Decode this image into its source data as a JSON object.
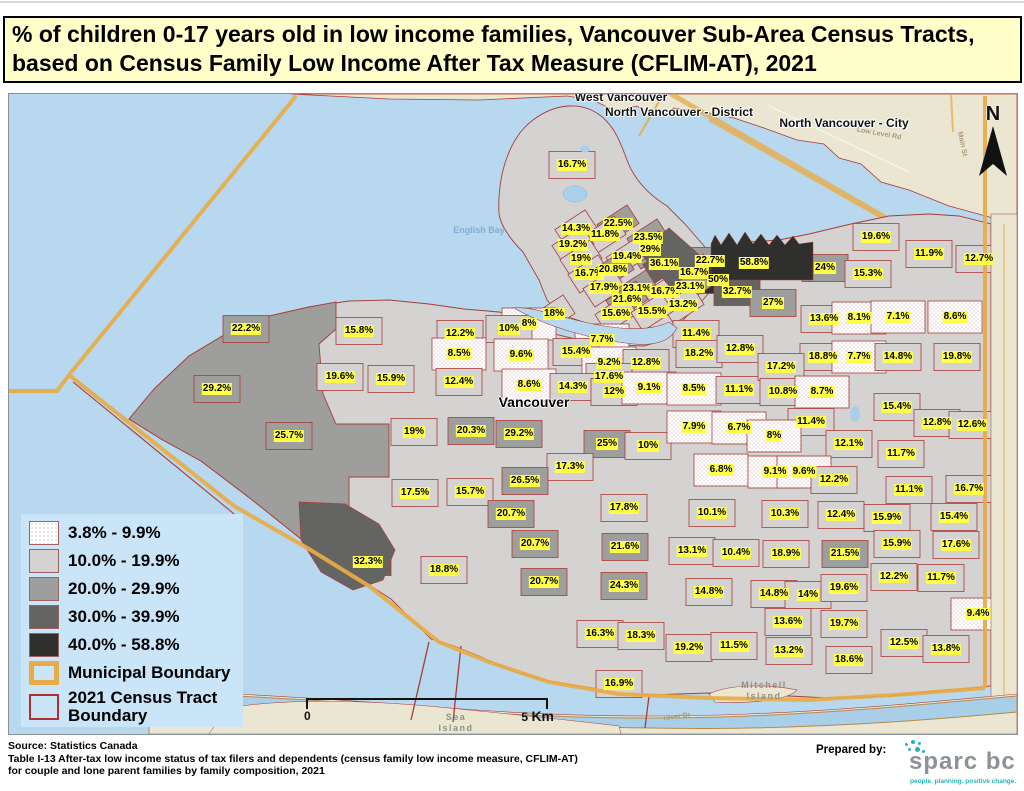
{
  "title": "% of children 0-17 years old in low income families, Vancouver Sub-Area Census Tracts, based on Census Family Low Income After Tax Measure (CFLIM-AT), 2021",
  "legend": {
    "classes": [
      {
        "label": "3.8% - 9.9%",
        "fill": "stipple"
      },
      {
        "label": "10.0% - 19.9%",
        "fill": "#d4d3d1"
      },
      {
        "label": "20.0% - 29.9%",
        "fill": "#9e9e9c"
      },
      {
        "label": "30.0% - 39.9%",
        "fill": "#646462"
      },
      {
        "label": "40.0% - 58.8%",
        "fill": "#2f2f2d"
      }
    ],
    "municipal_label": "Municipal Boundary",
    "census_line1": "2021 Census Tract",
    "census_line2": "Boundary"
  },
  "scale": {
    "zero": "0",
    "five": "5",
    "unit": "Km"
  },
  "north": {
    "letter": "N"
  },
  "colors": {
    "water": "#b7d8ee",
    "land_outside": "#ebe6d2",
    "legend_bg": "#c9e5f7",
    "label_bg": "#ffff4a",
    "municipal_boundary": "#e8ab47",
    "tract_boundary": "#a83c38",
    "title_bg": "#ffffc9",
    "logo_teal": "#26b3b3"
  },
  "map": {
    "places": [
      {
        "t": "West Vancouver",
        "x": 620,
        "y": 96,
        "c": "city",
        "rot": 0
      },
      {
        "t": "North Vancouver - District",
        "x": 678,
        "y": 111,
        "c": "city",
        "rot": 0
      },
      {
        "t": "North Vancouver - City",
        "x": 843,
        "y": 122,
        "c": "city",
        "rot": 0
      },
      {
        "t": "Vancouver",
        "x": 533,
        "y": 401,
        "c": "city-major",
        "rot": 0
      },
      {
        "t": "English Bay",
        "x": 478,
        "y": 229,
        "c": "water",
        "rot": 0
      },
      {
        "t": "Sea Island",
        "x": 455,
        "y": 722,
        "c": "island",
        "rot": 0
      },
      {
        "t": "Mitchell Island",
        "x": 763,
        "y": 690,
        "c": "island",
        "rot": 0
      },
      {
        "t": "River Dr",
        "x": 676,
        "y": 716,
        "c": "road",
        "rot": -8
      },
      {
        "t": "Low Level Rd",
        "x": 878,
        "y": 133,
        "c": "road",
        "rot": 10
      },
      {
        "t": "Main St",
        "x": 961,
        "y": 143,
        "c": "road",
        "rot": 78
      }
    ],
    "tracts_vxy": [
      [
        "16.7%",
        571,
        164
      ],
      [
        "14.3%",
        575,
        228
      ],
      [
        "22.5%",
        617,
        223
      ],
      [
        "11.8%",
        604,
        234
      ],
      [
        "23.5%",
        647,
        237
      ],
      [
        "19.2%",
        572,
        244
      ],
      [
        "29%",
        649,
        249
      ],
      [
        "19%",
        580,
        258
      ],
      [
        "19.4%",
        626,
        256
      ],
      [
        "36.1%",
        663,
        263
      ],
      [
        "22.7%",
        709,
        260
      ],
      [
        "58.8%",
        753,
        262
      ],
      [
        "16.7%",
        588,
        273
      ],
      [
        "20.8%",
        612,
        269
      ],
      [
        "16.7%",
        693,
        272
      ],
      [
        "50%",
        717,
        279
      ],
      [
        "17.9%",
        603,
        287
      ],
      [
        "23.1%",
        636,
        288
      ],
      [
        "16.7%",
        664,
        291
      ],
      [
        "23.1%",
        689,
        286
      ],
      [
        "32.7%",
        736,
        291
      ],
      [
        "21.6%",
        626,
        299
      ],
      [
        "13.2%",
        682,
        304
      ],
      [
        "27%",
        772,
        302
      ],
      [
        "15.6%",
        615,
        313
      ],
      [
        "15.5%",
        651,
        311
      ],
      [
        "22.2%",
        245,
        328
      ],
      [
        "15.8%",
        358,
        330
      ],
      [
        "12.2%",
        459,
        333
      ],
      [
        "8.5%",
        458,
        353
      ],
      [
        "19.6%",
        339,
        376
      ],
      [
        "15.9%",
        390,
        378
      ],
      [
        "12.4%",
        458,
        381
      ],
      [
        "29.2%",
        216,
        388
      ],
      [
        "25.7%",
        288,
        435
      ],
      [
        "18%",
        553,
        313
      ],
      [
        "8%",
        528,
        323
      ],
      [
        "10%",
        508,
        328
      ],
      [
        "7.7%",
        601,
        339
      ],
      [
        "11.4%",
        695,
        333
      ],
      [
        "9.6%",
        520,
        354
      ],
      [
        "15.4%",
        575,
        351
      ],
      [
        "9.2%",
        608,
        362
      ],
      [
        "12.8%",
        645,
        362
      ],
      [
        "18.2%",
        698,
        353
      ],
      [
        "12.8%",
        739,
        348
      ],
      [
        "17.6%",
        608,
        376
      ],
      [
        "8.6%",
        528,
        384
      ],
      [
        "14.3%",
        572,
        386
      ],
      [
        "12%",
        613,
        391
      ],
      [
        "9.1%",
        648,
        387
      ],
      [
        "8.5%",
        693,
        388
      ],
      [
        "11.1%",
        738,
        389
      ],
      [
        "19%",
        413,
        431
      ],
      [
        "20.3%",
        470,
        430
      ],
      [
        "29.2%",
        518,
        433
      ],
      [
        "25%",
        606,
        443
      ],
      [
        "10%",
        647,
        445
      ],
      [
        "7.9%",
        693,
        426
      ],
      [
        "6.7%",
        738,
        427
      ],
      [
        "17.3%",
        569,
        466
      ],
      [
        "26.5%",
        524,
        480
      ],
      [
        "6.8%",
        720,
        469
      ],
      [
        "17.5%",
        414,
        492
      ],
      [
        "15.7%",
        469,
        491
      ],
      [
        "20.7%",
        510,
        513
      ],
      [
        "17.8%",
        623,
        507
      ],
      [
        "10.1%",
        711,
        512
      ],
      [
        "20.7%",
        534,
        543
      ],
      [
        "21.6%",
        624,
        546
      ],
      [
        "13.1%",
        691,
        550
      ],
      [
        "10.4%",
        735,
        552
      ],
      [
        "32.3%",
        367,
        561
      ],
      [
        "18.8%",
        443,
        569
      ],
      [
        "20.7%",
        543,
        581
      ],
      [
        "24.3%",
        623,
        585
      ],
      [
        "14.8%",
        708,
        591
      ],
      [
        "19.6%",
        875,
        236
      ],
      [
        "11.9%",
        928,
        253
      ],
      [
        "12.7%",
        978,
        258
      ],
      [
        "24%",
        824,
        267
      ],
      [
        "15.3%",
        867,
        273
      ],
      [
        "13.6%",
        823,
        318
      ],
      [
        "8.1%",
        858,
        317
      ],
      [
        "7.1%",
        897,
        316
      ],
      [
        "8.6%",
        954,
        316
      ],
      [
        "18.8%",
        822,
        356
      ],
      [
        "7.7%",
        858,
        356
      ],
      [
        "14.8%",
        897,
        356
      ],
      [
        "19.8%",
        956,
        356
      ],
      [
        "17.2%",
        780,
        366
      ],
      [
        "10.8%",
        782,
        391
      ],
      [
        "8.7%",
        821,
        391
      ],
      [
        "15.4%",
        896,
        406
      ],
      [
        "12.8%",
        936,
        422
      ],
      [
        "12.6%",
        971,
        424
      ],
      [
        "11.4%",
        810,
        421
      ],
      [
        "8%",
        773,
        435
      ],
      [
        "12.1%",
        848,
        443
      ],
      [
        "11.7%",
        900,
        453
      ],
      [
        "9.1%",
        774,
        471
      ],
      [
        "9.6%",
        803,
        471
      ],
      [
        "12.2%",
        833,
        479
      ],
      [
        "11.1%",
        908,
        489
      ],
      [
        "16.7%",
        968,
        488
      ],
      [
        "10.3%",
        784,
        513
      ],
      [
        "12.4%",
        840,
        514
      ],
      [
        "15.9%",
        886,
        517
      ],
      [
        "15.4%",
        953,
        516
      ],
      [
        "15.9%",
        896,
        543
      ],
      [
        "17.6%",
        955,
        544
      ],
      [
        "18.9%",
        785,
        553
      ],
      [
        "21.5%",
        844,
        553
      ],
      [
        "12.2%",
        893,
        576
      ],
      [
        "11.7%",
        940,
        577
      ],
      [
        "14.8%",
        773,
        593
      ],
      [
        "14%",
        807,
        594
      ],
      [
        "19.6%",
        843,
        587
      ],
      [
        "9.4%",
        977,
        613
      ],
      [
        "13.6%",
        787,
        621
      ],
      [
        "19.7%",
        843,
        623
      ],
      [
        "16.3%",
        599,
        633
      ],
      [
        "18.3%",
        640,
        635
      ],
      [
        "12.5%",
        903,
        642
      ],
      [
        "13.8%",
        945,
        648
      ],
      [
        "19.2%",
        688,
        647
      ],
      [
        "11.5%",
        733,
        645
      ],
      [
        "13.2%",
        788,
        650
      ],
      [
        "18.6%",
        848,
        659
      ],
      [
        "16.9%",
        618,
        683
      ]
    ]
  },
  "footer": {
    "source_lines": [
      "Source: Statistics Canada",
      "Table I-13 After-tax low income status of tax filers and dependents (census family low income measure, CFLIM-AT)",
      "for couple and lone parent families by family composition, 2021"
    ],
    "prepared_by": "Prepared by:",
    "logo_text": "sparc bc",
    "logo_tagline": "people. planning. positive change."
  }
}
